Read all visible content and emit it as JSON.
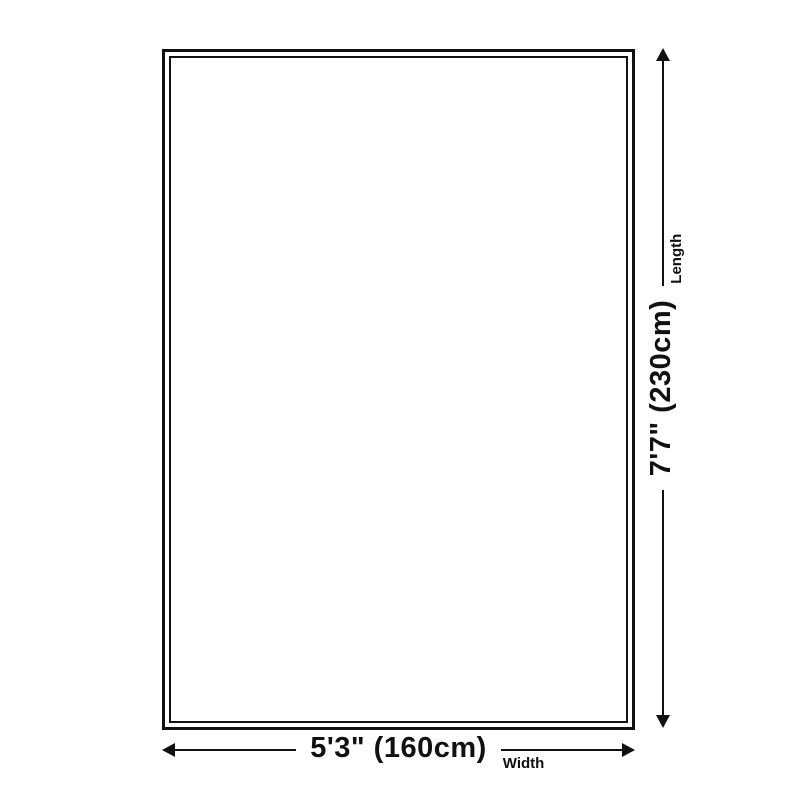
{
  "diagram": {
    "background_color": "#ffffff",
    "line_color": "#111111",
    "rug": {
      "border_style": "double",
      "border_color": "#111111"
    },
    "length": {
      "value": "7'7\" (230cm)",
      "label": "Length"
    },
    "width": {
      "value": "5'3\" (160cm)",
      "label": "Width"
    }
  }
}
